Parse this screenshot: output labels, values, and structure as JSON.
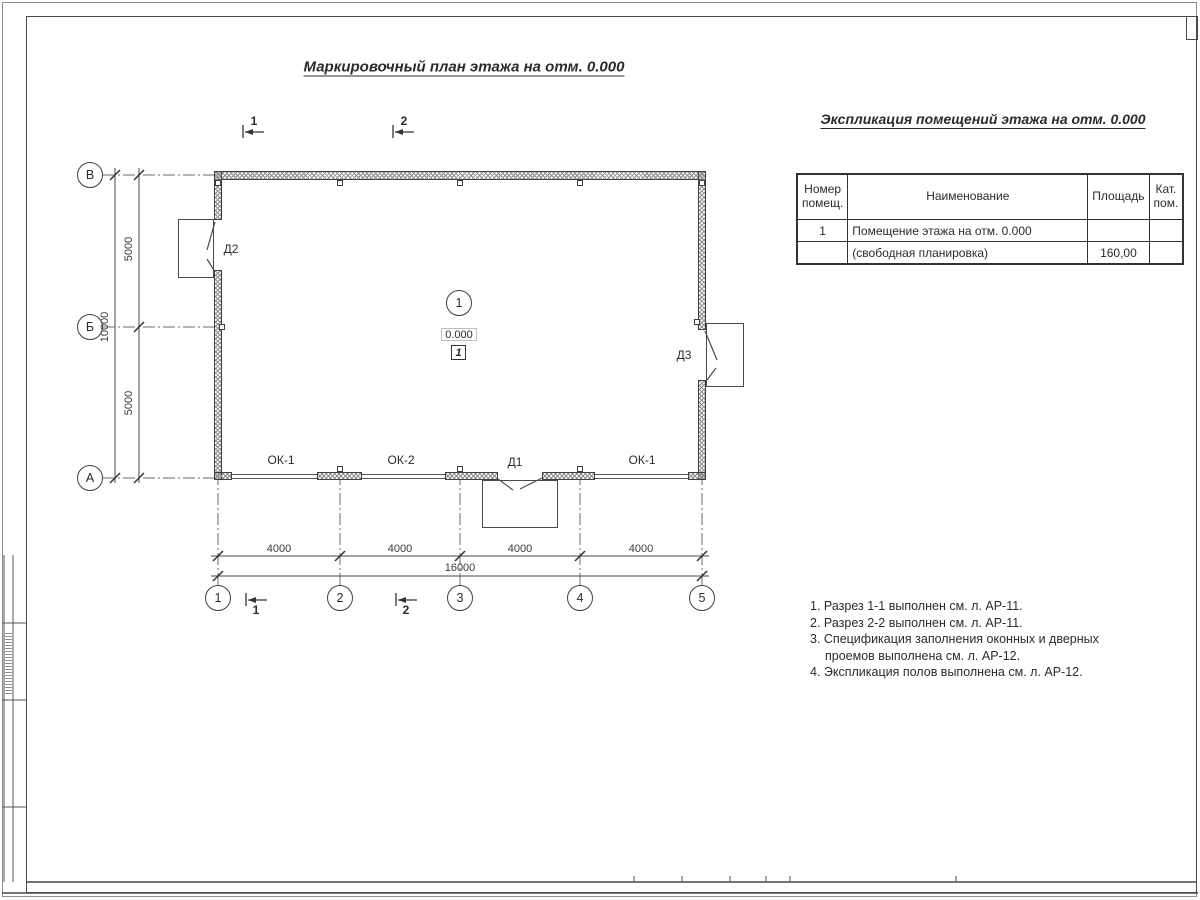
{
  "sheet": {
    "title": "Маркировочный план этажа на отм. 0.000",
    "spec_title": "Экспликация помещений этажа на отм. 0.000"
  },
  "axes": {
    "rows": [
      "В",
      "Б",
      "А"
    ],
    "cols": [
      "1",
      "2",
      "3",
      "4",
      "5"
    ]
  },
  "dims": {
    "v_segments": [
      "5000",
      "5000"
    ],
    "v_total": "10000",
    "h_segments": [
      "4000",
      "4000",
      "4000",
      "4000"
    ],
    "h_total": "16000"
  },
  "plan": {
    "bottom_labels": [
      "ОК-1",
      "ОК-2",
      "Д1",
      "ОК-1"
    ],
    "door_left": "Д2",
    "door_right": "Д3",
    "room": {
      "number": "1",
      "elevation": "0.000",
      "floor_mark": "1"
    }
  },
  "sections": {
    "s1": "1",
    "s2": "2"
  },
  "table": {
    "col_headers": [
      "Номер помещ.",
      "Наименование",
      "Площадь",
      "Кат. пом."
    ],
    "rows": [
      [
        "1",
        "Помещение этажа на отм. 0.000",
        "",
        ""
      ],
      [
        "",
        "(свободная планировка)",
        "160,00",
        ""
      ]
    ]
  },
  "notes": [
    "1. Разрез 1-1 выполнен см. л. АР-11.",
    "2. Разрез 2-2 выполнен см. л. АР-11.",
    "3. Спецификация заполнения оконных и дверных",
    "проемов выполнена см. л. АР-12.",
    "4. Экспликация полов выполнена см. л. АР-12."
  ],
  "colors": {
    "line": "#4a4a4a",
    "text": "#2b2b2b"
  }
}
